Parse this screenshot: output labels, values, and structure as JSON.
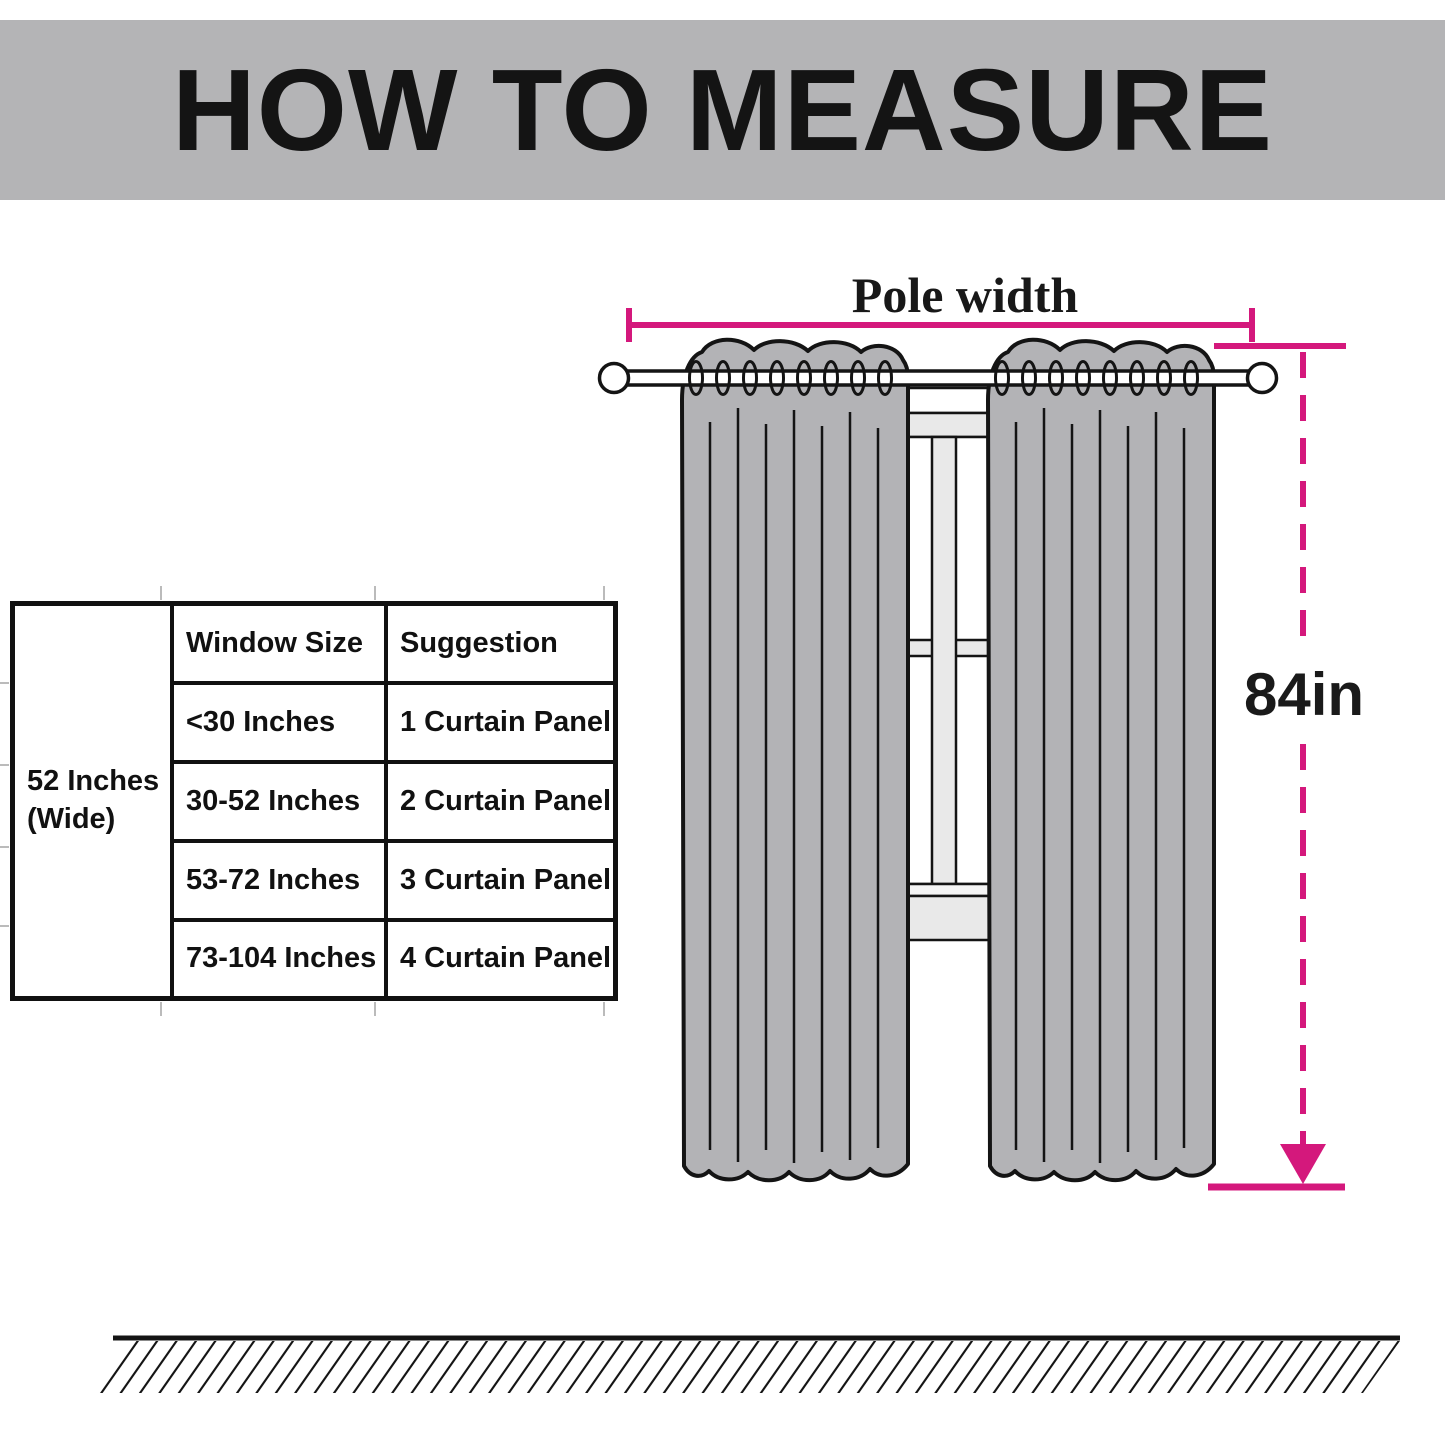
{
  "header": {
    "title": "HOW TO MEASURE"
  },
  "size_table": {
    "row_label": "52 Inches (Wide)",
    "columns": [
      "Window Size",
      "Suggestion"
    ],
    "rows": [
      {
        "window_size": "<30 Inches",
        "suggestion": "1 Curtain Panel"
      },
      {
        "window_size": "30-52 Inches",
        "suggestion": "2 Curtain Panel"
      },
      {
        "window_size": "53-72 Inches",
        "suggestion": "3 Curtain Panel"
      },
      {
        "window_size": "73-104 Inches",
        "suggestion": "4 Curtain Panel"
      }
    ]
  },
  "diagram": {
    "pole_width_label": "Pole width",
    "height_label": "84in"
  },
  "colors": {
    "banner_gray": "#b4b4b6",
    "curtain_gray": "#b3b3b6",
    "window_gray": "#e9e9e9",
    "window_gray_light": "#f4f4f4",
    "measure_pink": "#d4187c",
    "outline_black": "#141414",
    "grid_stub_gray": "#bbbbbb"
  }
}
